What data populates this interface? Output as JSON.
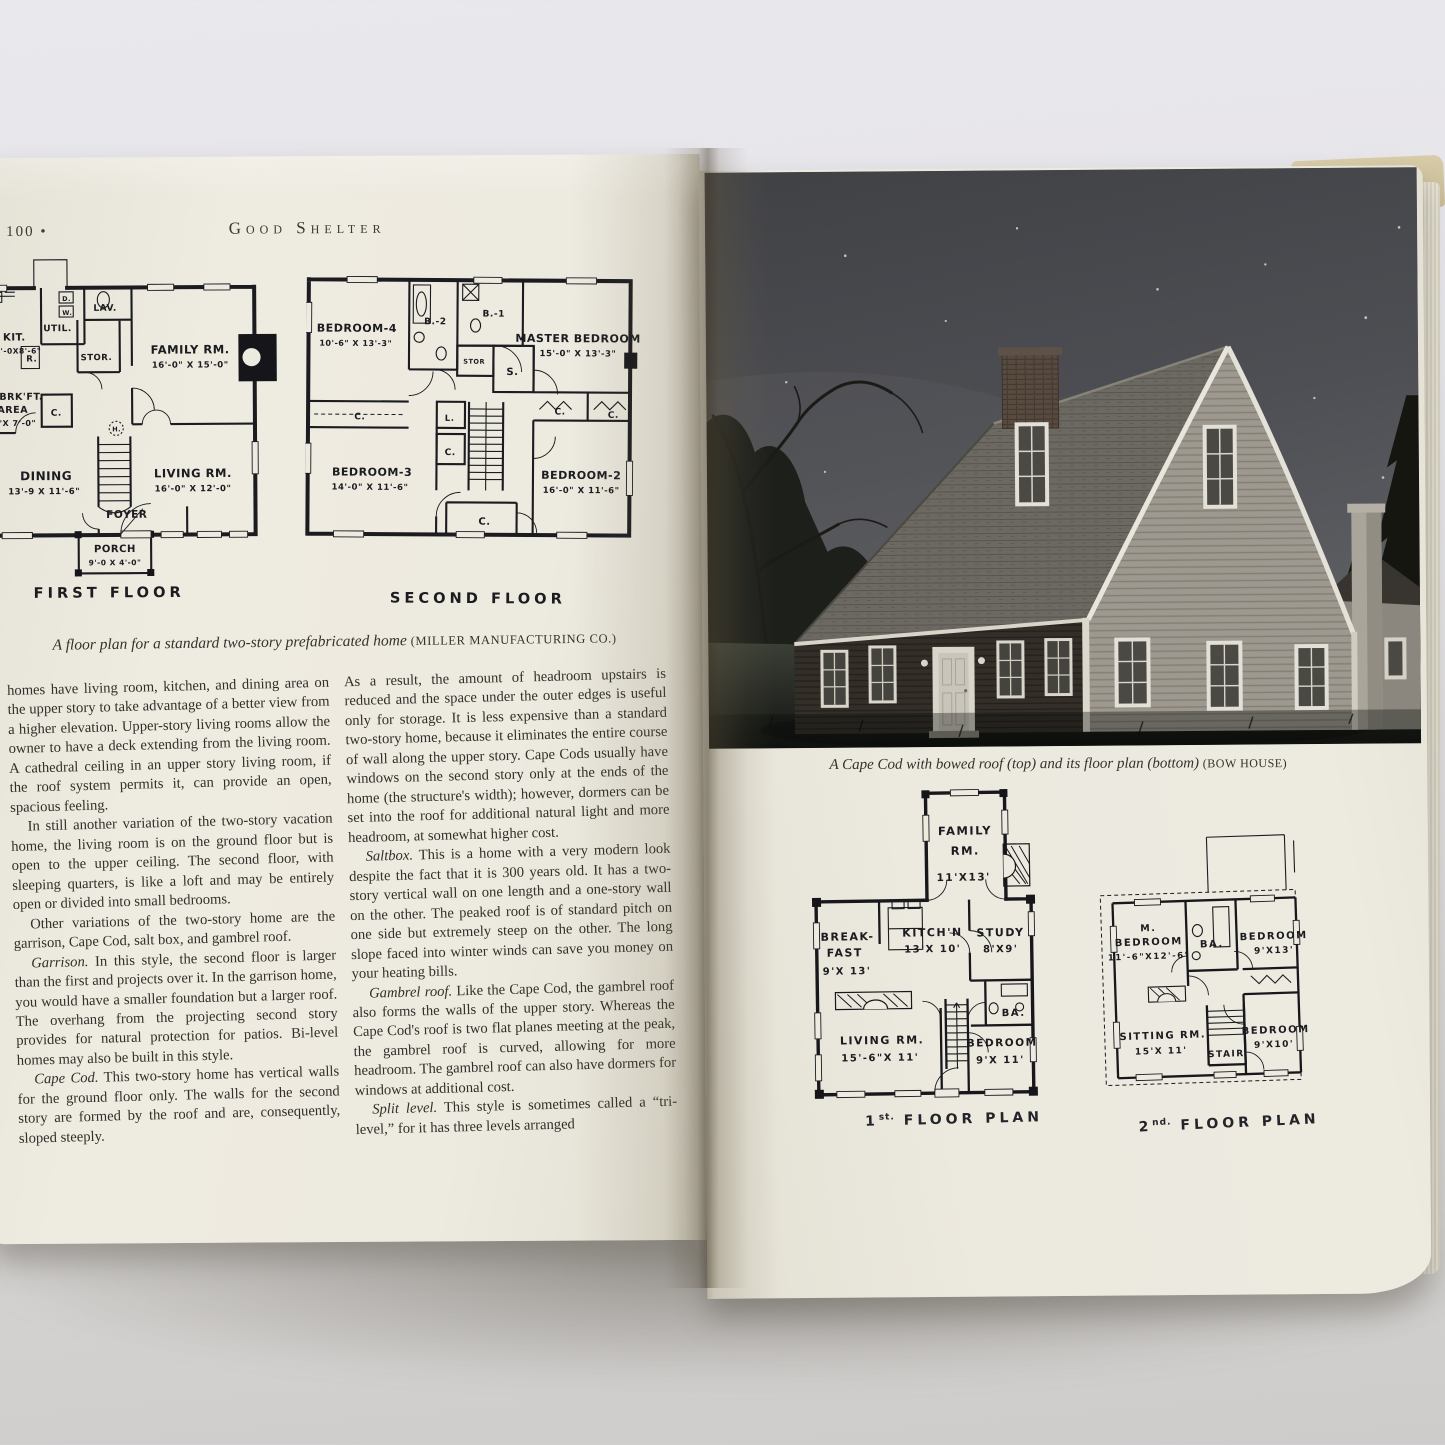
{
  "book": {
    "left_page": {
      "page_number": "100",
      "page_number_bullet": "•",
      "running_head": "Good Shelter",
      "first_floor": {
        "title": "FIRST FLOOR",
        "labels": {
          "kit": "KIT.",
          "kit_dims": "10'-0X8'-6\"",
          "util": "UTIL.",
          "d": "D.",
          "w": "W.",
          "lav": "LAV.",
          "stor": "STOR.",
          "r": "R.",
          "family": "FAMILY RM.",
          "family_dims": "16'-0\" X 15'-0\"",
          "brkft1": "BRK'FT.",
          "brkft2": "AREA",
          "brkft_dims": "8'X 7'-0\"",
          "c": "C.",
          "h": "H.",
          "dining": "DINING",
          "dining_dims": "13'-9 X 11'-6\"",
          "living": "LIVING RM.",
          "living_dims": "16'-0\" X 12'-0\"",
          "foyer": "FOYER",
          "porch": "PORCH",
          "porch_dims": "9'-0 X 4'-0\""
        }
      },
      "second_floor": {
        "title": "SECOND FLOOR",
        "labels": {
          "bedroom4": "BEDROOM-4",
          "bedroom4_dims": "10'-6\" X 13'-3\"",
          "b2": "B.-2",
          "b1": "B.-1",
          "master": "MASTER BEDROOM",
          "master_dims": "15'-0\" X 13'-3\"",
          "stor": "STOR",
          "s": "S.",
          "c1": "C.",
          "l": "L.",
          "c2": "C.",
          "c3": "C.",
          "c4": "C.",
          "c5": "C.",
          "bedroom3": "BEDROOM-3",
          "bedroom3_dims": "14'-0\" X 11'-6\"",
          "bedroom2": "BEDROOM-2",
          "bedroom2_dims": "16'-0\" X 11'-6\""
        }
      },
      "plan_caption": {
        "text": "A floor plan for a standard two-story prefabricated home",
        "credit": "(MILLER MANUFACTURING CO.)"
      },
      "columns": {
        "left": [
          {
            "lead": "",
            "text": "homes have living room, kitchen, and dining area on the upper story to take advantage of a better view from a higher elevation. Upper-story living rooms allow the owner to have a deck extending from the living room. A cathedral ceiling in an upper story living room, if the roof system permits it, can provide an open, spacious feeling."
          },
          {
            "lead": "",
            "text": "In still another variation of the two-story vacation home, the living room is on the ground floor but is open to the upper ceiling. The second floor, with sleeping quarters, is like a loft and may be entirely open or divided into small bedrooms."
          },
          {
            "lead": "",
            "text": "Other variations of the two-story home are the garrison, Cape Cod, salt box, and gambrel roof."
          },
          {
            "lead": "Garrison.",
            "text": " In this style, the second floor is larger than the first and projects over it. In the garrison home, you would have a smaller foundation but a larger roof. The overhang from the projecting second story provides for natural protection for patios. Bi-level homes may also be built in this style."
          },
          {
            "lead": "Cape Cod.",
            "text": " This two-story home has vertical walls for the ground floor only. The walls for the second story are formed by the roof and are, consequently, sloped steeply."
          }
        ],
        "right": [
          {
            "lead": "",
            "text": "As a result, the amount of headroom upstairs is reduced and the space under the outer edges is useful only for storage. It is less expensive than a standard two-story home, because it eliminates the entire course of wall along the upper story. Cape Cods usually have windows on the second story only at the ends of the home (the structure's width); however, dormers can be set into the roof for additional natural light and more headroom, at somewhat higher cost."
          },
          {
            "lead": "Saltbox.",
            "text": " This is a home with a very modern look despite the fact that it is 300 years old. It has a two-story vertical wall on one length and a one-story wall on the other. The peaked roof is of standard pitch on one side but extremely steep on the other. The long slope faced into winter winds can save you money on your heating bills."
          },
          {
            "lead": "Gambrel roof.",
            "text": " Like the Cape Cod, the gambrel roof also forms the walls of the upper story. Whereas the Cape Cod's roof is two flat planes meeting at the peak, the gambrel roof is curved, allowing for more headroom. The gambrel roof can also have dormers for windows at additional cost."
          },
          {
            "lead": "Split level.",
            "text": " This style is sometimes called a “tri-level,” for it has three levels arranged"
          }
        ]
      }
    },
    "right_page": {
      "photo_caption": {
        "text": "A Cape Cod with bowed roof (top) and its floor plan (bottom)",
        "credit": "(BOW HOUSE)"
      },
      "plan1": {
        "title": {
          "num": "1",
          "sup": "st.",
          "rest": " FLOOR PLAN"
        },
        "labels": {
          "family1": "FAMILY",
          "family2": "RM.",
          "family_dims": "11'X13'",
          "breakfast1": "BREAK-",
          "breakfast2": "FAST",
          "breakfast_dims": "9'X 13'",
          "kitchen": "KITCH'N",
          "kitchen_dims": "13'X 10'",
          "study": "STUDY",
          "study_dims": "8'X9'",
          "ba": "BA.",
          "living": "LIVING RM.",
          "living_dims": "15'-6\"X 11'",
          "bedroom": "BEDROOM",
          "bedroom_dims": "9'X 11'"
        }
      },
      "plan2": {
        "title": {
          "num": "2",
          "sup": "nd.",
          "rest": " FLOOR PLAN"
        },
        "labels": {
          "m": "M.",
          "mbedroom": "BEDROOM",
          "mbedroom_dims": "11'-6\"X12'-6\"",
          "ba": "BA.",
          "bedroom_a": "BEDROOM",
          "bedroom_a_dims": "9'X13'",
          "sitting": "SITTING RM.",
          "sitting_dims": "15'X 11'",
          "stair": "STAIR",
          "bedroom_b": "BEDROOM",
          "bedroom_b_dims": "9'X10'"
        }
      }
    }
  }
}
